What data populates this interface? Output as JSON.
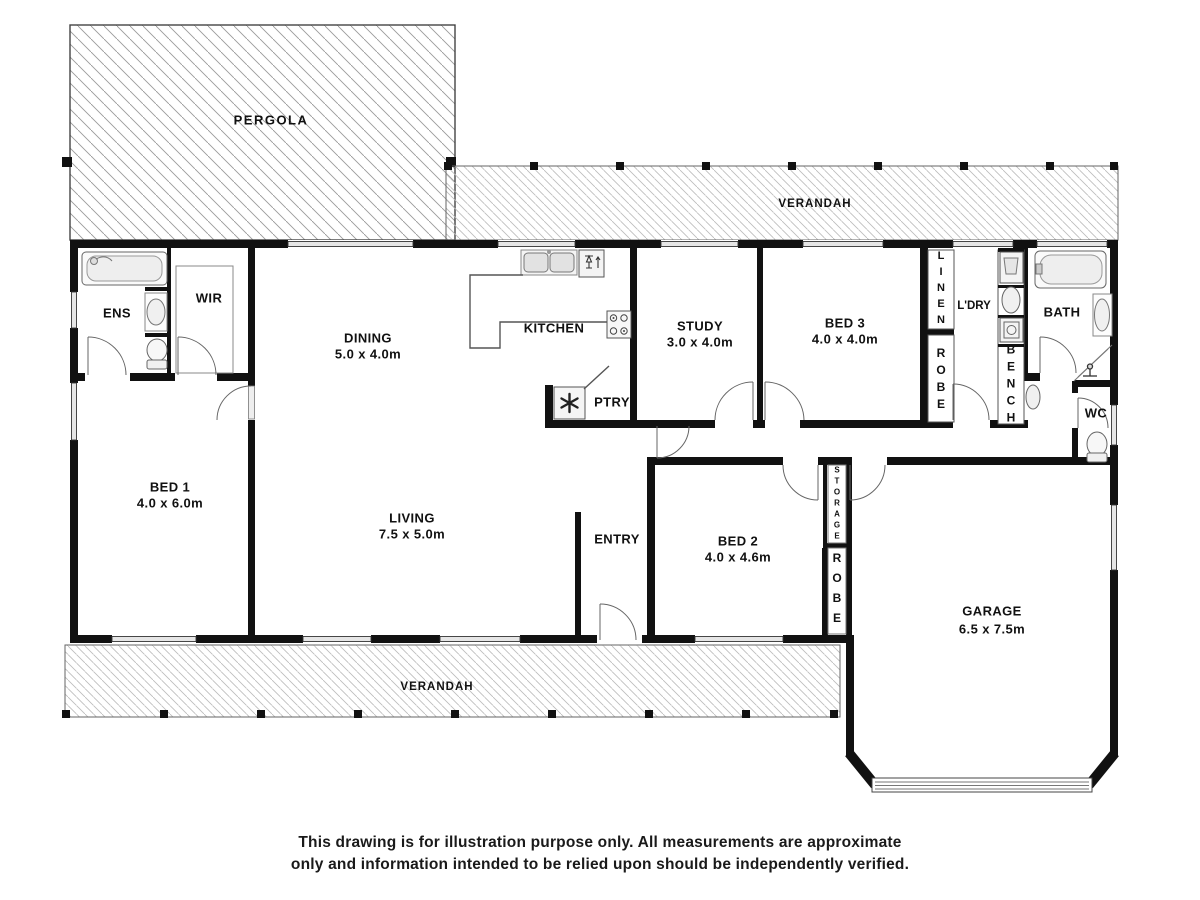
{
  "outdoor": {
    "pergola": "PERGOLA",
    "verandah_top": "VERANDAH",
    "verandah_bottom": "VERANDAH"
  },
  "rooms": {
    "ens": "ENS",
    "wir": "WIR",
    "dining": {
      "name": "DINING",
      "dims": "5.0 x 4.0m"
    },
    "kitchen": "KITCHEN",
    "ptry": "PTRY",
    "study": {
      "name": "STUDY",
      "dims": "3.0 x 4.0m"
    },
    "bed3": {
      "name": "BED 3",
      "dims": "4.0 x 4.0m"
    },
    "linen": "LINEN",
    "robe_top": "ROBE",
    "ldry": "L'DRY",
    "bench": "BENCH",
    "bath": "BATH",
    "wc": "WC",
    "bed1": {
      "name": "BED 1",
      "dims": "4.0 x 6.0m"
    },
    "living": {
      "name": "LIVING",
      "dims": "7.5 x 5.0m"
    },
    "entry": "ENTRY",
    "bed2": {
      "name": "BED 2",
      "dims": "4.0 x 4.6m"
    },
    "storage": "STORAGE",
    "robe_bottom": "ROBE",
    "garage": {
      "name": "GARAGE",
      "dims": "6.5 x 7.5m"
    }
  },
  "disclaimer": {
    "line1": "This drawing is for illustration purpose only. All measurements are approximate",
    "line2": "only and information intended to be relied upon should be independently verified."
  },
  "colors": {
    "wall": "#111111",
    "hatch_pergola": "#999999",
    "hatch_verandah": "#bbbbbb",
    "window_fill": "#e6e6e6",
    "background": "#ffffff"
  }
}
